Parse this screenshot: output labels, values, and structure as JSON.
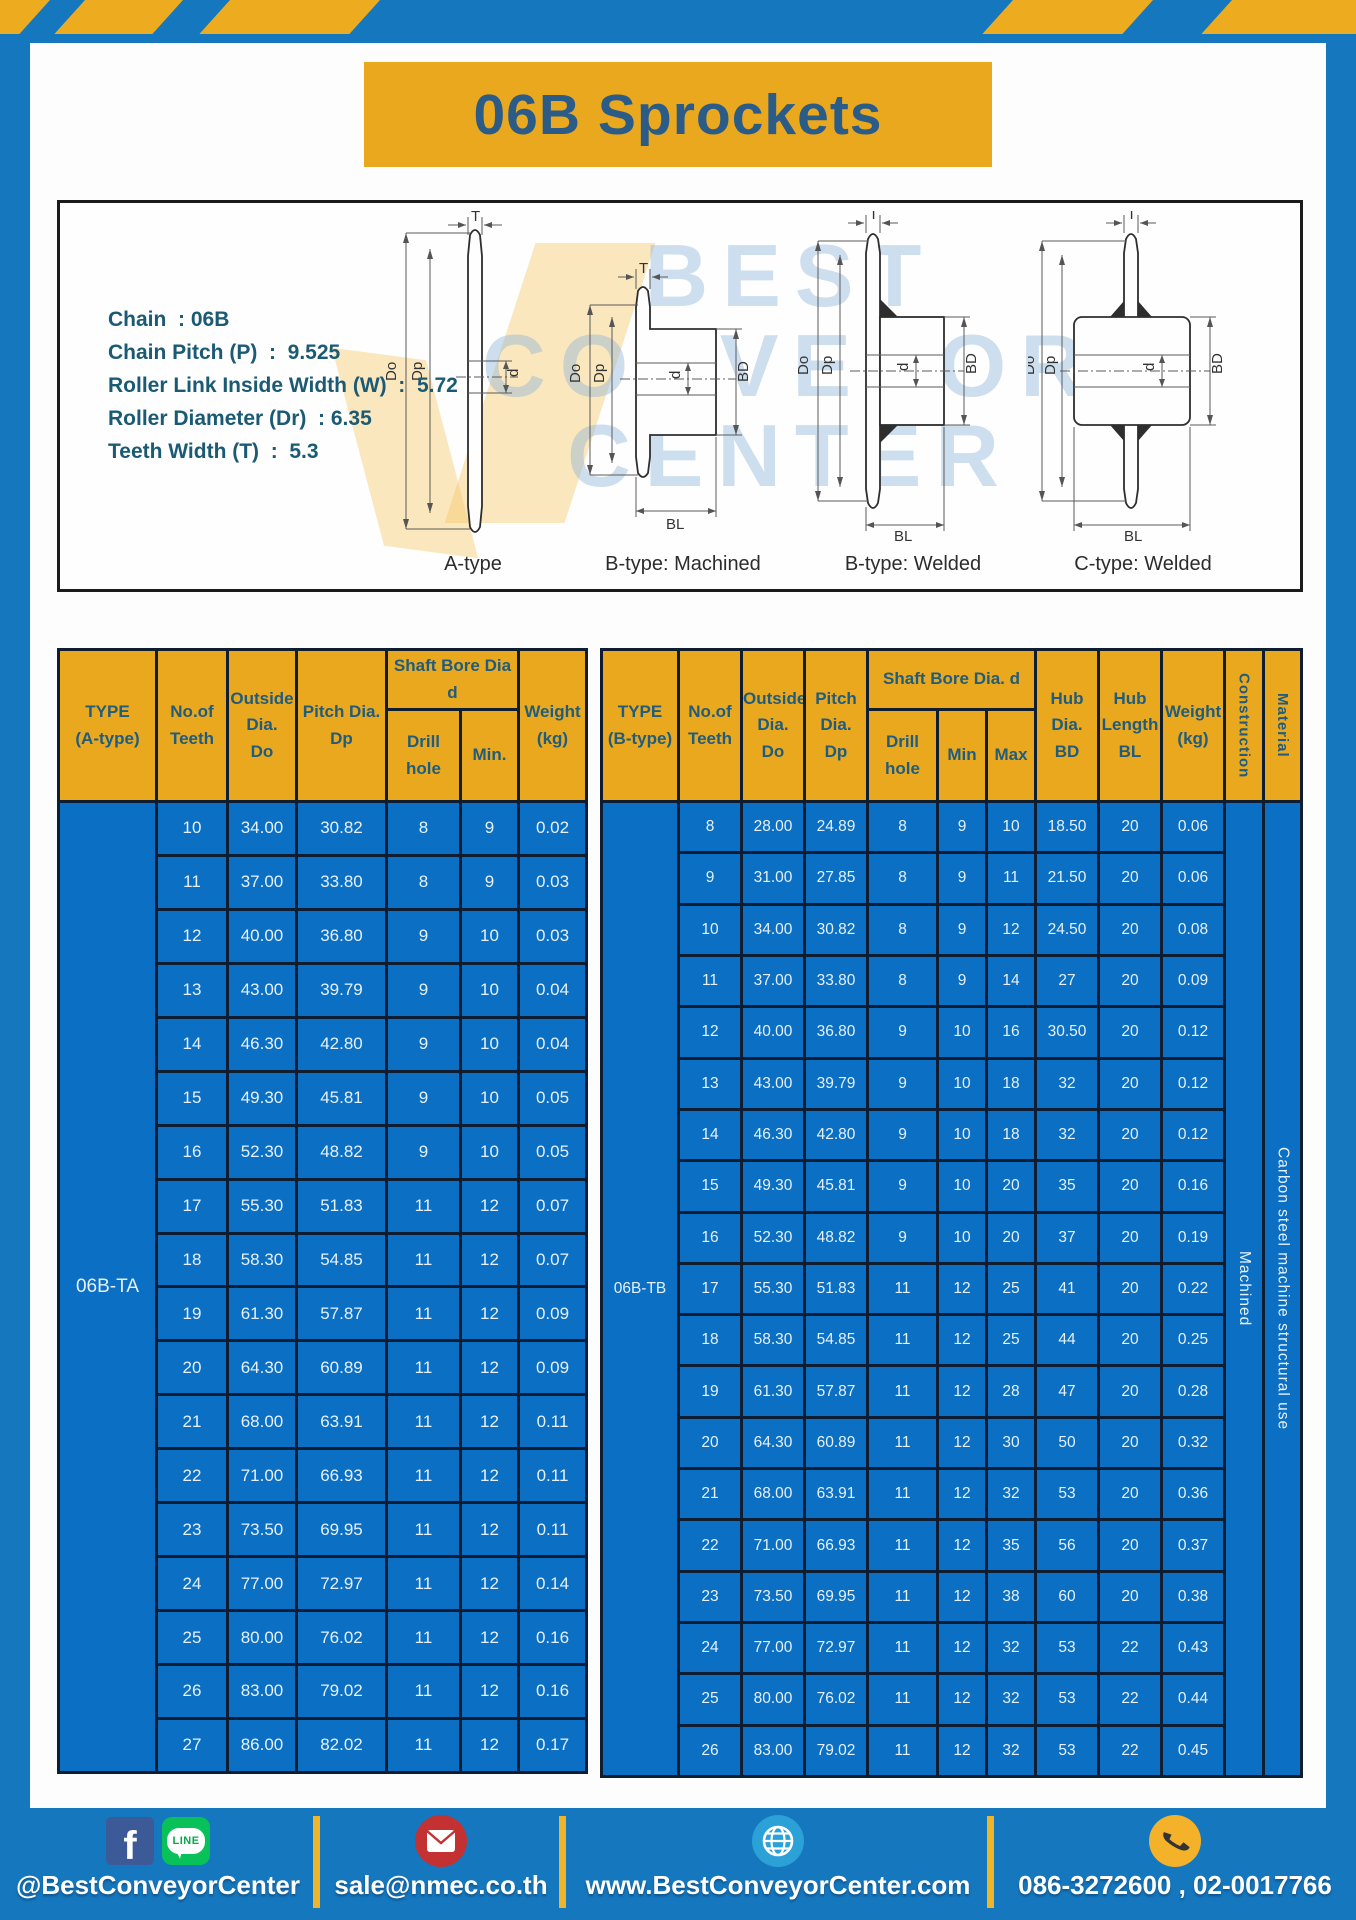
{
  "page": {
    "title": "06B Sprockets"
  },
  "colors": {
    "frame_blue": "#1577be",
    "table_blue": "#0b6fc3",
    "accent_yellow": "#eaa81e",
    "stripe_yellow": "#edac20",
    "header_text_blue": "#1f5c7d",
    "border_dark": "#0f1d31",
    "facebook_blue": "#3d5a98",
    "line_green": "#09c159",
    "mail_red": "#c43133",
    "globe_blue": "#2ba1d8",
    "phone_yellow": "#f3b229"
  },
  "specs": [
    "Chain  : 06B",
    "Chain Pitch (P)  :  9.525",
    "Roller Link Inside Width (W)  :  5.72",
    "Roller Diameter (Dr)  : 6.35",
    "Teeth Width (T)  :  5.3"
  ],
  "diagrams": {
    "watermark": [
      "BEST",
      "CONVEYOR",
      "CENTER"
    ],
    "dims": {
      "T": "T",
      "Do": "Do",
      "Dp": "Dp",
      "d": "d",
      "BD": "BD",
      "BL": "BL"
    },
    "items": [
      {
        "caption": "A-type"
      },
      {
        "caption": "B-type: Machined"
      },
      {
        "caption": "B-type: Welded"
      },
      {
        "caption": "C-type: Welded"
      }
    ]
  },
  "table_a": {
    "headers": {
      "type": "TYPE\n(A-type)",
      "teeth": "No.of\nTeeth",
      "outside": "Outside\nDia.\nDo",
      "pitch": "Pitch Dia.\nDp",
      "shaft_bore": "Shaft Bore Dia d",
      "drill": "Drill hole",
      "min": "Min.",
      "weight": "Weight\n(kg)"
    },
    "type_label": "06B-TA",
    "rows": [
      [
        "10",
        "34.00",
        "30.82",
        "8",
        "9",
        "0.02"
      ],
      [
        "11",
        "37.00",
        "33.80",
        "8",
        "9",
        "0.03"
      ],
      [
        "12",
        "40.00",
        "36.80",
        "9",
        "10",
        "0.03"
      ],
      [
        "13",
        "43.00",
        "39.79",
        "9",
        "10",
        "0.04"
      ],
      [
        "14",
        "46.30",
        "42.80",
        "9",
        "10",
        "0.04"
      ],
      [
        "15",
        "49.30",
        "45.81",
        "9",
        "10",
        "0.05"
      ],
      [
        "16",
        "52.30",
        "48.82",
        "9",
        "10",
        "0.05"
      ],
      [
        "17",
        "55.30",
        "51.83",
        "11",
        "12",
        "0.07"
      ],
      [
        "18",
        "58.30",
        "54.85",
        "11",
        "12",
        "0.07"
      ],
      [
        "19",
        "61.30",
        "57.87",
        "11",
        "12",
        "0.09"
      ],
      [
        "20",
        "64.30",
        "60.89",
        "11",
        "12",
        "0.09"
      ],
      [
        "21",
        "68.00",
        "63.91",
        "11",
        "12",
        "0.11"
      ],
      [
        "22",
        "71.00",
        "66.93",
        "11",
        "12",
        "0.11"
      ],
      [
        "23",
        "73.50",
        "69.95",
        "11",
        "12",
        "0.11"
      ],
      [
        "24",
        "77.00",
        "72.97",
        "11",
        "12",
        "0.14"
      ],
      [
        "25",
        "80.00",
        "76.02",
        "11",
        "12",
        "0.16"
      ],
      [
        "26",
        "83.00",
        "79.02",
        "11",
        "12",
        "0.16"
      ],
      [
        "27",
        "86.00",
        "82.02",
        "11",
        "12",
        "0.17"
      ]
    ]
  },
  "table_b": {
    "headers": {
      "type": "TYPE\n(B-type)",
      "teeth": "No.of\nTeeth",
      "outside": "Outside\nDia.\nDo",
      "pitch": "Pitch\nDia.\nDp",
      "shaft_bore": "Shaft Bore Dia.  d",
      "drill": "Drill hole",
      "min": "Min",
      "max": "Max",
      "hub_dia": "Hub\nDia.\nBD",
      "hub_len": "Hub\nLength\nBL",
      "weight": "Weight\n(kg)",
      "construction": "Construction",
      "material": "Material"
    },
    "type_label": "06B-TB",
    "construction_value": "Machined",
    "material_value": "Carbon  steel  machine  structural  use",
    "rows": [
      [
        "8",
        "28.00",
        "24.89",
        "8",
        "9",
        "10",
        "18.50",
        "20",
        "0.06"
      ],
      [
        "9",
        "31.00",
        "27.85",
        "8",
        "9",
        "11",
        "21.50",
        "20",
        "0.06"
      ],
      [
        "10",
        "34.00",
        "30.82",
        "8",
        "9",
        "12",
        "24.50",
        "20",
        "0.08"
      ],
      [
        "11",
        "37.00",
        "33.80",
        "8",
        "9",
        "14",
        "27",
        "20",
        "0.09"
      ],
      [
        "12",
        "40.00",
        "36.80",
        "9",
        "10",
        "16",
        "30.50",
        "20",
        "0.12"
      ],
      [
        "13",
        "43.00",
        "39.79",
        "9",
        "10",
        "18",
        "32",
        "20",
        "0.12"
      ],
      [
        "14",
        "46.30",
        "42.80",
        "9",
        "10",
        "18",
        "32",
        "20",
        "0.12"
      ],
      [
        "15",
        "49.30",
        "45.81",
        "9",
        "10",
        "20",
        "35",
        "20",
        "0.16"
      ],
      [
        "16",
        "52.30",
        "48.82",
        "9",
        "10",
        "20",
        "37",
        "20",
        "0.19"
      ],
      [
        "17",
        "55.30",
        "51.83",
        "11",
        "12",
        "25",
        "41",
        "20",
        "0.22"
      ],
      [
        "18",
        "58.30",
        "54.85",
        "11",
        "12",
        "25",
        "44",
        "20",
        "0.25"
      ],
      [
        "19",
        "61.30",
        "57.87",
        "11",
        "12",
        "28",
        "47",
        "20",
        "0.28"
      ],
      [
        "20",
        "64.30",
        "60.89",
        "11",
        "12",
        "30",
        "50",
        "20",
        "0.32"
      ],
      [
        "21",
        "68.00",
        "63.91",
        "11",
        "12",
        "32",
        "53",
        "20",
        "0.36"
      ],
      [
        "22",
        "71.00",
        "66.93",
        "11",
        "12",
        "35",
        "56",
        "20",
        "0.37"
      ],
      [
        "23",
        "73.50",
        "69.95",
        "11",
        "12",
        "38",
        "60",
        "20",
        "0.38"
      ],
      [
        "24",
        "77.00",
        "72.97",
        "11",
        "12",
        "32",
        "53",
        "22",
        "0.43"
      ],
      [
        "25",
        "80.00",
        "76.02",
        "11",
        "12",
        "32",
        "53",
        "22",
        "0.44"
      ],
      [
        "26",
        "83.00",
        "79.02",
        "11",
        "12",
        "32",
        "53",
        "22",
        "0.45"
      ]
    ]
  },
  "footer": {
    "fb_letter": "f",
    "line_text": "LINE",
    "social_label": "@BestConveyorCenter",
    "email": "sale@nmec.co.th",
    "website": "www.BestConveyorCenter.com",
    "phones": "086-3272600 , 02-0017766"
  }
}
